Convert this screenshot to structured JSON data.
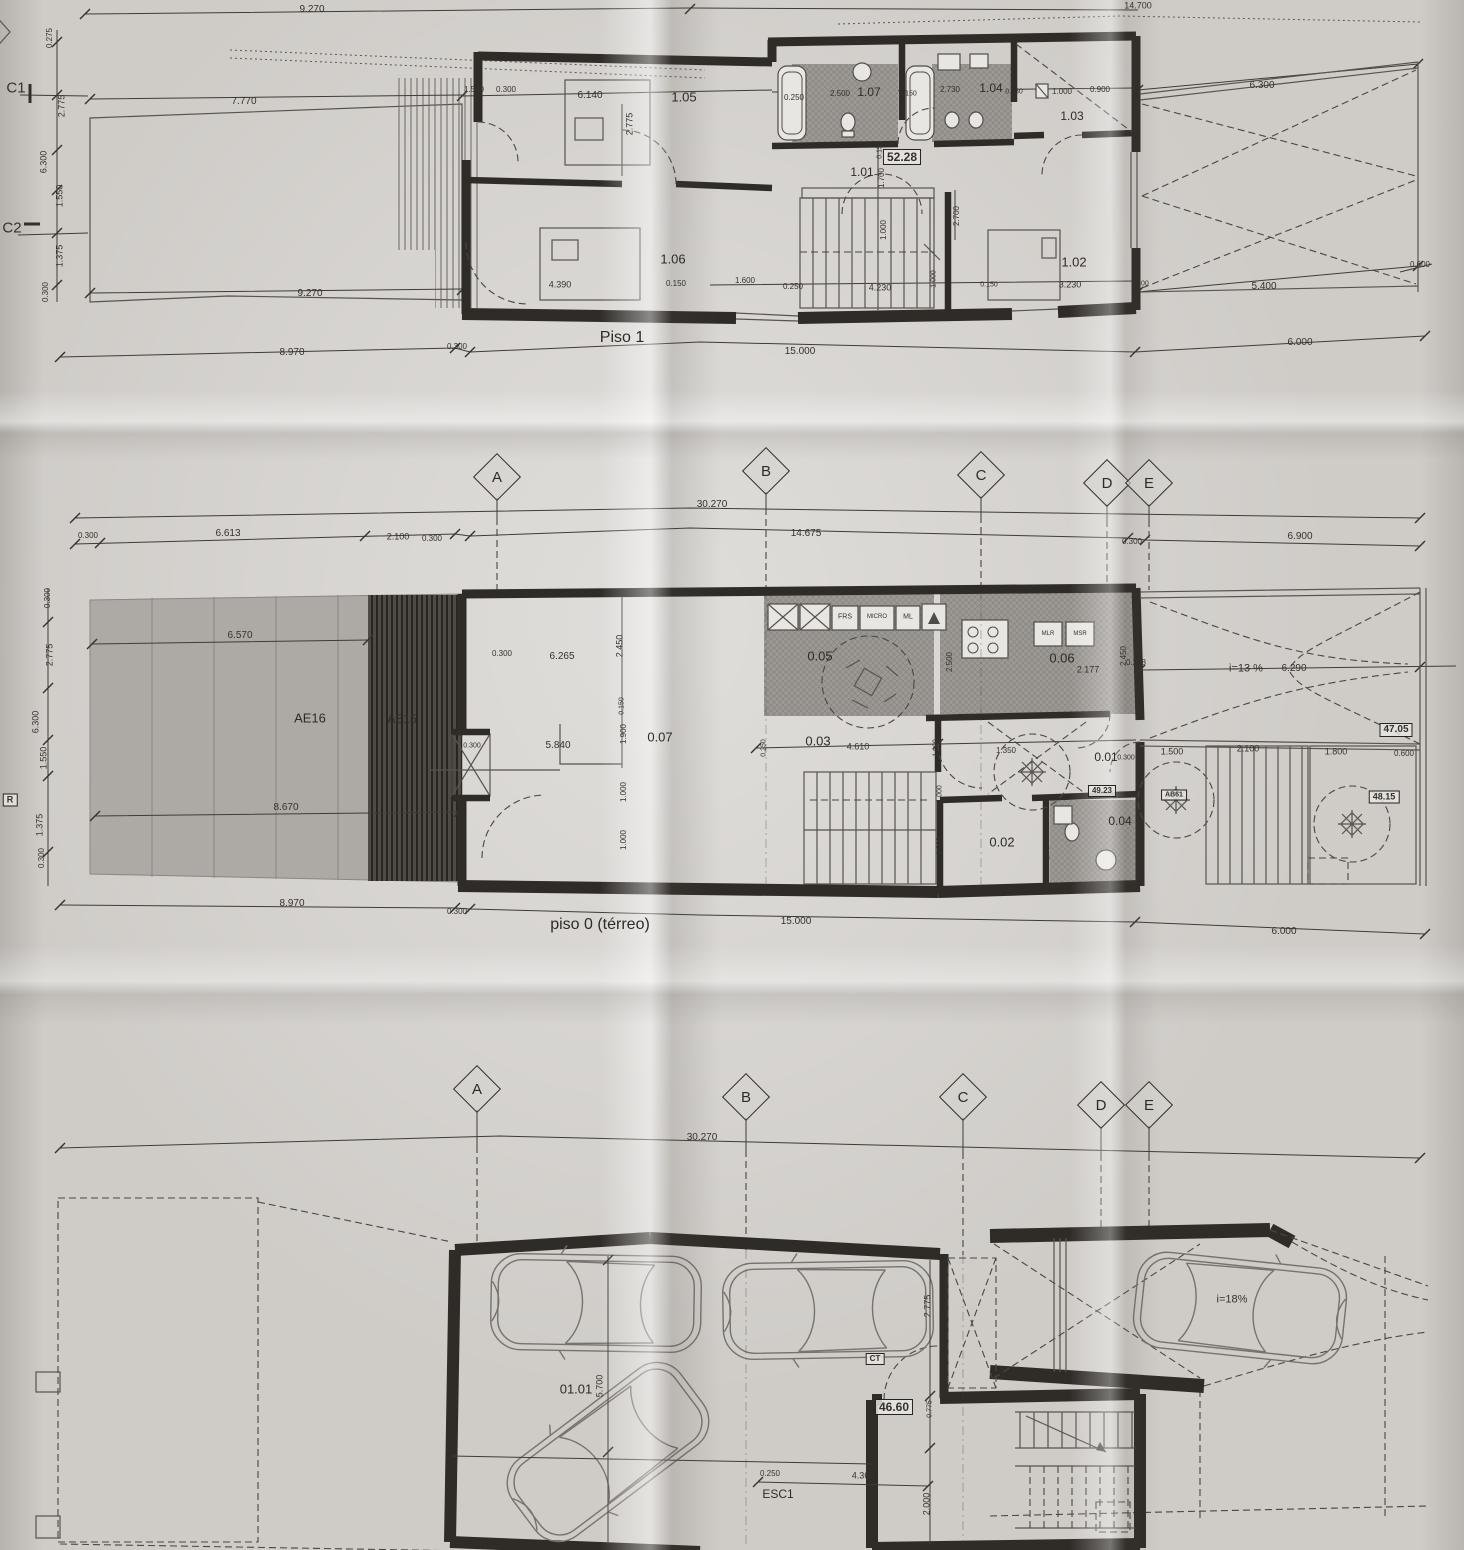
{
  "meta": {
    "sheet_titles": {
      "floor1": "Piso 1",
      "floor0": "piso 0 (térreo)"
    }
  },
  "colors": {
    "paper": "#cfccc8",
    "wall": "#2f2b27",
    "thin_line": "#57534e",
    "patio_fill": "#adaaa6",
    "deck_dark": "#4e4a45",
    "hatch_fill": "#9c9894"
  },
  "grid_markers": [
    {
      "t": "A",
      "x": 497,
      "y": 477
    },
    {
      "t": "B",
      "x": 766,
      "y": 471
    },
    {
      "t": "C",
      "x": 981,
      "y": 475
    },
    {
      "t": "D",
      "x": 1107,
      "y": 483
    },
    {
      "t": "E",
      "x": 1149,
      "y": 483
    },
    {
      "t": "A",
      "x": 477,
      "y": 1089
    },
    {
      "t": "B",
      "x": 746,
      "y": 1097
    },
    {
      "t": "C",
      "x": 963,
      "y": 1097
    },
    {
      "t": "D",
      "x": 1101,
      "y": 1105
    },
    {
      "t": "E",
      "x": 1149,
      "y": 1105
    }
  ],
  "labels": [
    {
      "t": "9.270",
      "x": 312,
      "y": 10
    },
    {
      "t": "14.700",
      "x": 1138,
      "y": 6,
      "s": 9
    },
    {
      "t": "C1",
      "x": 16,
      "y": 88,
      "s": 15,
      "k": "grid-axis"
    },
    {
      "t": "C2",
      "x": 12,
      "y": 228,
      "s": 15,
      "k": "grid-axis"
    },
    {
      "t": "0.275",
      "x": 50,
      "y": 38,
      "r": -90,
      "s": 8
    },
    {
      "t": "2.775",
      "x": 62,
      "y": 106,
      "r": -90,
      "s": 9
    },
    {
      "t": "6.300",
      "x": 44,
      "y": 162,
      "r": -90,
      "s": 9
    },
    {
      "t": "1.550",
      "x": 60,
      "y": 196,
      "r": -90,
      "s": 9
    },
    {
      "t": "1.375",
      "x": 60,
      "y": 256,
      "r": -90,
      "s": 9
    },
    {
      "t": "0.300",
      "x": 46,
      "y": 292,
      "r": -90,
      "s": 8
    },
    {
      "t": "7.770",
      "x": 244,
      "y": 102
    },
    {
      "t": "9.270",
      "x": 310,
      "y": 294
    },
    {
      "t": "1.500",
      "x": 474,
      "y": 90,
      "s": 8
    },
    {
      "t": "0.300",
      "x": 506,
      "y": 90,
      "s": 8
    },
    {
      "t": "6.140",
      "x": 590,
      "y": 96
    },
    {
      "t": "1.05",
      "x": 684,
      "y": 97,
      "s": 13,
      "k": "room"
    },
    {
      "t": "2.775",
      "x": 630,
      "y": 124,
      "r": -90,
      "s": 9
    },
    {
      "t": "0.250",
      "x": 794,
      "y": 98,
      "s": 8
    },
    {
      "t": "2.500",
      "x": 840,
      "y": 94,
      "s": 8
    },
    {
      "t": "1.07",
      "x": 869,
      "y": 92,
      "s": 12,
      "k": "room"
    },
    {
      "t": "0.150",
      "x": 908,
      "y": 94,
      "s": 7
    },
    {
      "t": "2.730",
      "x": 950,
      "y": 90,
      "s": 8
    },
    {
      "t": "1.04",
      "x": 991,
      "y": 88,
      "s": 12,
      "k": "room"
    },
    {
      "t": "0.150",
      "x": 1014,
      "y": 92,
      "s": 7
    },
    {
      "t": "1.000",
      "x": 1062,
      "y": 92,
      "s": 8
    },
    {
      "t": "0.900",
      "x": 1100,
      "y": 90,
      "s": 8
    },
    {
      "t": "1.03",
      "x": 1072,
      "y": 116,
      "s": 12,
      "k": "room"
    },
    {
      "t": "6.300",
      "x": 1262,
      "y": 86
    },
    {
      "t": "52.28",
      "x": 902,
      "y": 157,
      "b": true,
      "s": 12,
      "k": "area"
    },
    {
      "t": "1.01",
      "x": 862,
      "y": 172,
      "s": 12,
      "k": "room"
    },
    {
      "t": "0.150",
      "x": 880,
      "y": 150,
      "r": -90,
      "s": 7
    },
    {
      "t": "1.700",
      "x": 882,
      "y": 178,
      "r": -90,
      "s": 8
    },
    {
      "t": "1.000",
      "x": 884,
      "y": 230,
      "r": -90,
      "s": 8
    },
    {
      "t": "2.700",
      "x": 957,
      "y": 216,
      "r": -90,
      "s": 8
    },
    {
      "t": "1.02",
      "x": 1074,
      "y": 262,
      "s": 13,
      "k": "room"
    },
    {
      "t": "1.06",
      "x": 673,
      "y": 259,
      "s": 13,
      "k": "room"
    },
    {
      "t": "4.390",
      "x": 560,
      "y": 285,
      "s": 9
    },
    {
      "t": "0.150",
      "x": 676,
      "y": 284,
      "s": 8
    },
    {
      "t": "1.600",
      "x": 745,
      "y": 281,
      "s": 8
    },
    {
      "t": "0.250",
      "x": 793,
      "y": 287,
      "s": 8
    },
    {
      "t": "4.230",
      "x": 880,
      "y": 288,
      "s": 9
    },
    {
      "t": "1.000",
      "x": 934,
      "y": 279,
      "r": -90,
      "s": 7
    },
    {
      "t": "0.150",
      "x": 989,
      "y": 285,
      "s": 7
    },
    {
      "t": "3.230",
      "x": 1070,
      "y": 285,
      "s": 9
    },
    {
      "t": "0.300",
      "x": 1140,
      "y": 284,
      "s": 7
    },
    {
      "t": "5.400",
      "x": 1264,
      "y": 287
    },
    {
      "t": "0.600",
      "x": 1420,
      "y": 265,
      "s": 8
    },
    {
      "t": "8.970",
      "x": 292,
      "y": 353
    },
    {
      "t": "0.300",
      "x": 457,
      "y": 347,
      "s": 8
    },
    {
      "t": "15.000",
      "x": 800,
      "y": 352
    },
    {
      "t": "6.000",
      "x": 1300,
      "y": 343
    },
    {
      "t": "30.270",
      "x": 712,
      "y": 505
    },
    {
      "t": "0.300",
      "x": 88,
      "y": 536,
      "s": 8
    },
    {
      "t": "6.613",
      "x": 228,
      "y": 534
    },
    {
      "t": "2.100",
      "x": 398,
      "y": 537,
      "s": 9
    },
    {
      "t": "0.300",
      "x": 432,
      "y": 539,
      "s": 8
    },
    {
      "t": "14.675",
      "x": 806,
      "y": 534
    },
    {
      "t": "0.300",
      "x": 1132,
      "y": 542,
      "s": 8
    },
    {
      "t": "6.900",
      "x": 1300,
      "y": 537
    },
    {
      "t": "0.300",
      "x": 48,
      "y": 598,
      "r": -90,
      "s": 8
    },
    {
      "t": "6.570",
      "x": 240,
      "y": 636
    },
    {
      "t": "2.775",
      "x": 50,
      "y": 655,
      "r": -90,
      "s": 9
    },
    {
      "t": "6.300",
      "x": 36,
      "y": 722,
      "r": -90,
      "s": 9
    },
    {
      "t": "1.550",
      "x": 44,
      "y": 758,
      "r": -90,
      "s": 9
    },
    {
      "t": "1.375",
      "x": 40,
      "y": 825,
      "r": -90,
      "s": 9
    },
    {
      "t": "0.300",
      "x": 42,
      "y": 858,
      "r": -90,
      "s": 8
    },
    {
      "t": "AE16",
      "x": 310,
      "y": 718,
      "s": 13,
      "k": "room"
    },
    {
      "t": "AE15",
      "x": 402,
      "y": 719,
      "s": 12,
      "k": "room"
    },
    {
      "t": "8.670",
      "x": 286,
      "y": 808
    },
    {
      "t": "R",
      "x": 10,
      "y": 800,
      "s": 9,
      "b": true
    },
    {
      "t": "0.300",
      "x": 472,
      "y": 746,
      "s": 7
    },
    {
      "t": "0.300",
      "x": 502,
      "y": 654,
      "s": 8
    },
    {
      "t": "6.265",
      "x": 562,
      "y": 657
    },
    {
      "t": "2.450",
      "x": 620,
      "y": 646,
      "r": -90,
      "s": 9
    },
    {
      "t": "0.150",
      "x": 622,
      "y": 706,
      "r": -90,
      "s": 7
    },
    {
      "t": "1.900",
      "x": 624,
      "y": 734,
      "r": -90,
      "s": 8
    },
    {
      "t": "1.000",
      "x": 624,
      "y": 792,
      "r": -90,
      "s": 8
    },
    {
      "t": "1.000",
      "x": 624,
      "y": 840,
      "r": -90,
      "s": 8
    },
    {
      "t": "0.07",
      "x": 660,
      "y": 737,
      "s": 13,
      "k": "room"
    },
    {
      "t": "5.840",
      "x": 558,
      "y": 746
    },
    {
      "t": "FRS",
      "x": 845,
      "y": 617,
      "s": 7
    },
    {
      "t": "MICRO",
      "x": 877,
      "y": 617,
      "s": 6
    },
    {
      "t": "ML",
      "x": 908,
      "y": 617,
      "s": 7
    },
    {
      "t": "0.05",
      "x": 820,
      "y": 656,
      "s": 13,
      "k": "room"
    },
    {
      "t": "2.500",
      "x": 950,
      "y": 662,
      "r": -90,
      "s": 8
    },
    {
      "t": "MLR",
      "x": 1048,
      "y": 634,
      "s": 6
    },
    {
      "t": "MSR",
      "x": 1080,
      "y": 634,
      "s": 6
    },
    {
      "t": "0.06",
      "x": 1062,
      "y": 658,
      "s": 13,
      "k": "room"
    },
    {
      "t": "2.177",
      "x": 1088,
      "y": 670,
      "s": 9
    },
    {
      "t": "2.450",
      "x": 1124,
      "y": 656,
      "r": -90,
      "s": 8
    },
    {
      "t": "0.228",
      "x": 1136,
      "y": 663,
      "s": 8
    },
    {
      "t": "i=13 %",
      "x": 1246,
      "y": 669,
      "s": 11
    },
    {
      "t": "6.290",
      "x": 1294,
      "y": 669
    },
    {
      "t": "47.05",
      "x": 1396,
      "y": 730,
      "b": true,
      "s": 10,
      "k": "area"
    },
    {
      "t": "0.03",
      "x": 818,
      "y": 741,
      "s": 13,
      "k": "room"
    },
    {
      "t": "0.250",
      "x": 764,
      "y": 748,
      "r": -90,
      "s": 7
    },
    {
      "t": "4.610",
      "x": 858,
      "y": 747,
      "s": 9
    },
    {
      "t": "1.000",
      "x": 936,
      "y": 748,
      "r": -90,
      "s": 7
    },
    {
      "t": "1.000",
      "x": 940,
      "y": 794,
      "r": -90,
      "s": 7
    },
    {
      "t": "1.000",
      "x": 940,
      "y": 846,
      "r": -90,
      "s": 7
    },
    {
      "t": "1.350",
      "x": 1006,
      "y": 751,
      "s": 8
    },
    {
      "t": "0.01",
      "x": 1106,
      "y": 757,
      "s": 12,
      "k": "room"
    },
    {
      "t": "49.23",
      "x": 1102,
      "y": 791,
      "b": true,
      "s": 8,
      "k": "area"
    },
    {
      "t": "0.04",
      "x": 1120,
      "y": 821,
      "s": 12,
      "k": "room"
    },
    {
      "t": "0.02",
      "x": 1002,
      "y": 842,
      "s": 13,
      "k": "room"
    },
    {
      "t": "1.75",
      "x": 1048,
      "y": 853,
      "r": -90,
      "s": 7
    },
    {
      "t": "0.300",
      "x": 1126,
      "y": 758,
      "s": 7
    },
    {
      "t": "1.500",
      "x": 1172,
      "y": 752,
      "s": 9
    },
    {
      "t": "AB61",
      "x": 1174,
      "y": 795,
      "b": true,
      "s": 7
    },
    {
      "t": "2.100",
      "x": 1248,
      "y": 749,
      "s": 9
    },
    {
      "t": "1.800",
      "x": 1336,
      "y": 752,
      "s": 9
    },
    {
      "t": "0.600",
      "x": 1404,
      "y": 754,
      "s": 8
    },
    {
      "t": "48.15",
      "x": 1384,
      "y": 797,
      "b": true,
      "s": 9,
      "k": "area"
    },
    {
      "t": "8.970",
      "x": 292,
      "y": 904
    },
    {
      "t": "0.300",
      "x": 457,
      "y": 912,
      "s": 8
    },
    {
      "t": "15.000",
      "x": 796,
      "y": 922
    },
    {
      "t": "6.000",
      "x": 1284,
      "y": 932
    },
    {
      "t": "30.270",
      "x": 702,
      "y": 1138
    },
    {
      "t": "01.01",
      "x": 576,
      "y": 1389,
      "s": 13,
      "k": "room"
    },
    {
      "t": "5.700",
      "x": 600,
      "y": 1386,
      "r": -90,
      "s": 9
    },
    {
      "t": "CT",
      "x": 875,
      "y": 1359,
      "b": true,
      "s": 8
    },
    {
      "t": "2.775",
      "x": 928,
      "y": 1306,
      "r": -90,
      "s": 9
    },
    {
      "t": "46.60",
      "x": 894,
      "y": 1407,
      "b": true,
      "s": 12,
      "k": "area"
    },
    {
      "t": "0.775",
      "x": 930,
      "y": 1409,
      "r": -90,
      "s": 7
    },
    {
      "t": "0.250",
      "x": 770,
      "y": 1474,
      "s": 8
    },
    {
      "t": "4.360",
      "x": 863,
      "y": 1476,
      "s": 9
    },
    {
      "t": "ESC1",
      "x": 778,
      "y": 1494,
      "s": 12,
      "k": "room"
    },
    {
      "t": "2.000",
      "x": 927,
      "y": 1504,
      "r": -90,
      "s": 9
    },
    {
      "t": "i=18%",
      "x": 1232,
      "y": 1300,
      "s": 11
    }
  ]
}
